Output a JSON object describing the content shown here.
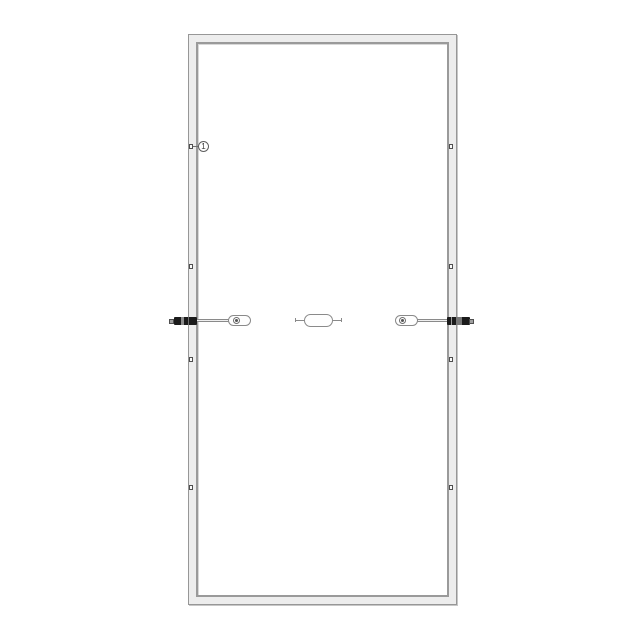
{
  "callout": {
    "label": "1"
  },
  "counts": {
    "holes_per_side": 4,
    "junction_boxes": 3,
    "connectors": 2
  },
  "colors": {
    "background": "#ffffff",
    "frame_fill": "#ededed",
    "frame_line": "#979797",
    "inner_line": "#9a9a9a",
    "connector_body": "#1b1b1b",
    "connector_tip": "#a0a0a0",
    "cable_fill": "#efefef"
  }
}
